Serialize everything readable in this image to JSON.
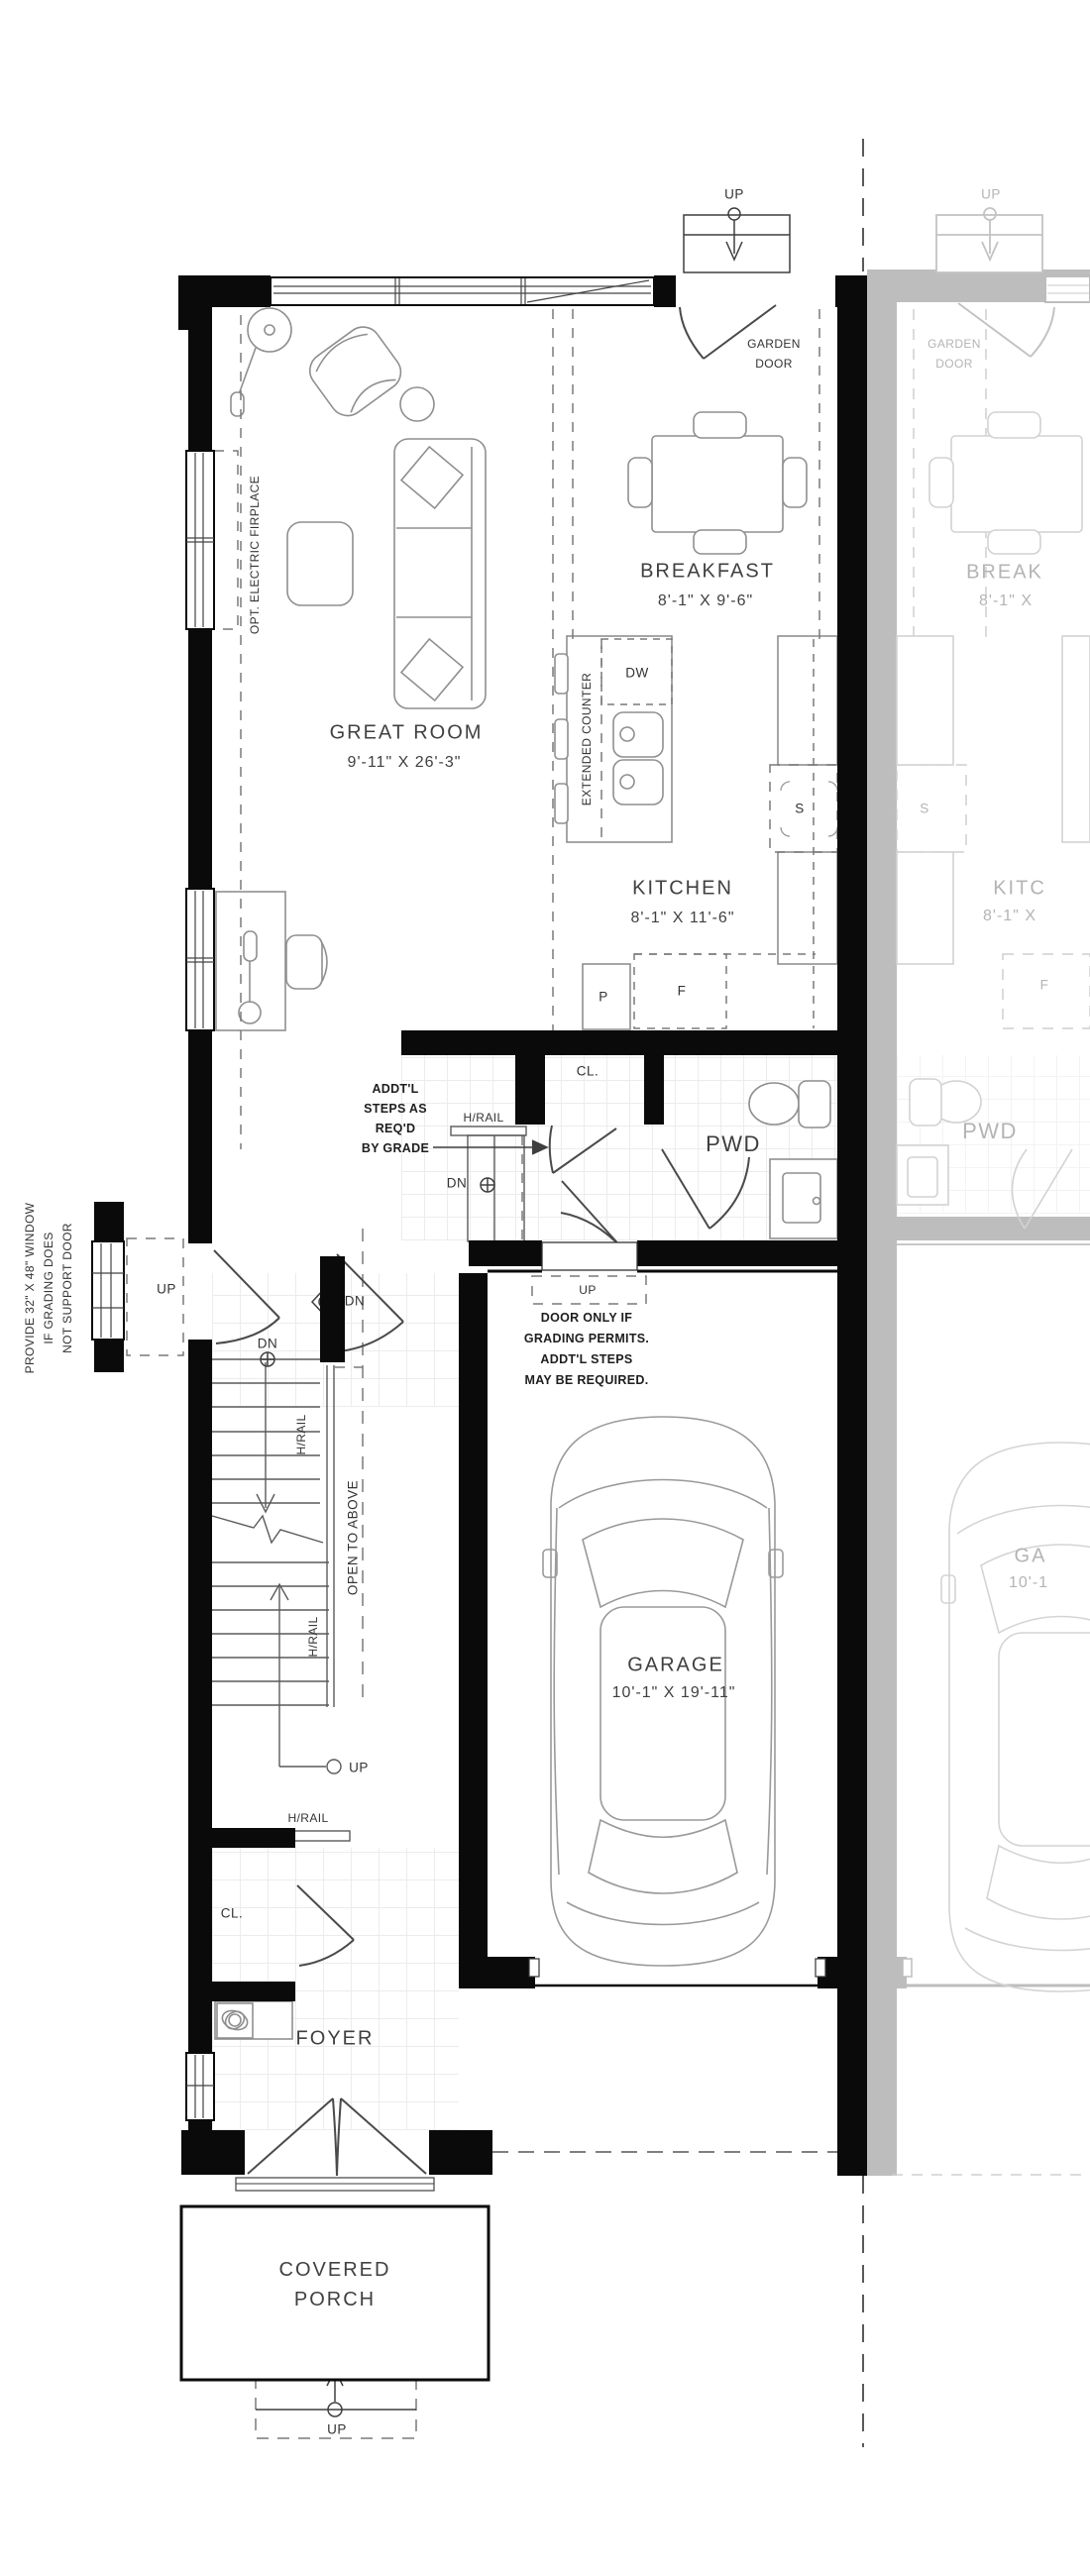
{
  "title": "Townhouse main floor plan",
  "colors": {
    "wall": "#0a0a0a",
    "adjacent_unit_wall": "#bdbdbd",
    "line": "#666666",
    "furniture_line": "#8f8f8f",
    "tile_line": "#ececec"
  },
  "rooms": {
    "great_room": {
      "name": "GREAT ROOM",
      "dims": "9'-11\" X 26'-3\""
    },
    "breakfast": {
      "name": "BREAKFAST",
      "dims": "8'-1\" X 9'-6\""
    },
    "kitchen": {
      "name": "KITCHEN",
      "dims": "8'-1\" X 11'-6\""
    },
    "powder": {
      "name": "PWD"
    },
    "garage": {
      "name": "GARAGE",
      "dims": "10'-1\" X 19'-11\""
    },
    "foyer": {
      "name": "FOYER"
    },
    "covered_porch": {
      "name": "COVERED PORCH"
    },
    "hall_closet": {
      "label": "CL."
    },
    "foyer_closet": {
      "label": "CL."
    }
  },
  "labels": {
    "up": "UP",
    "dn": "DN",
    "hrail": "H/RAIL",
    "dw": "DW",
    "s": "S",
    "p": "P",
    "f": "F",
    "open_to_above": "OPEN TO ABOVE",
    "extended_counter": "EXTENDED COUNTER",
    "opt_fireplace": "OPT. ELECTRIC FIRPLACE",
    "garden_door": [
      "GARDEN",
      "DOOR"
    ]
  },
  "notes": {
    "addtl_steps": [
      "ADDT'L",
      "STEPS AS",
      "REQ'D",
      "BY GRADE"
    ],
    "door_grading": [
      "DOOR ONLY IF",
      "GRADING PERMITS.",
      "ADDT'L STEPS",
      "MAY BE REQUIRED."
    ],
    "window_grading": [
      "PROVIDE 32\" X 48\" WINDOW",
      "IF GRADING DOES",
      "NOT SUPPORT DOOR"
    ]
  },
  "adjacent_unit": {
    "up": "UP",
    "garden_door": [
      "GARDEN",
      "DOOR"
    ],
    "breakfast_name": "BREAK",
    "breakfast_dims": "8'-1\" X",
    "kitchen_name": "KITC",
    "kitchen_dims": "8'-1\" X",
    "powder": "PWD",
    "garage_name": "GA",
    "garage_dims": "10'-1",
    "s": "S",
    "f": "F"
  }
}
